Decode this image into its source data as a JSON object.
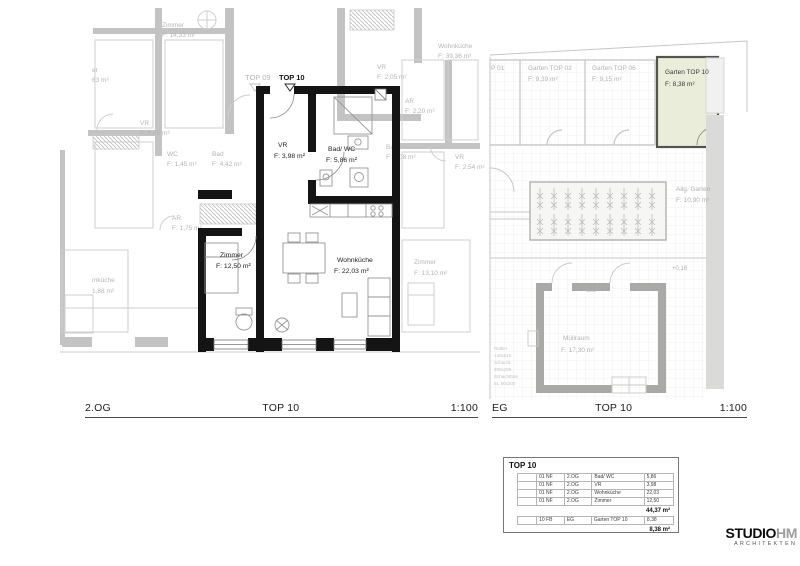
{
  "plan_og": {
    "footer": {
      "level": "2.OG",
      "unit": "TOP 10",
      "scale": "1:100"
    },
    "markers": {
      "faded": "TOP 09",
      "active": "TOP 10"
    },
    "rooms": {
      "vr": {
        "name": "VR",
        "area": "F: 3,98 m²"
      },
      "bad": {
        "name": "Bad/ WC",
        "area": "F: 5,86 m²"
      },
      "zimmer": {
        "name": "Zimmer",
        "area": "F: 12,50 m²"
      },
      "wohnkueche": {
        "name": "Wohnküche",
        "area": "F: 22,03 m²"
      }
    },
    "context": [
      {
        "name": "Zimmer",
        "area": "F: 14,33 m²"
      },
      {
        "name": "er",
        "area": "63 m²"
      },
      {
        "name": "VR",
        "area": "F: 6,88 m²"
      },
      {
        "name": "WC",
        "area": "F: 1,45 m²"
      },
      {
        "name": "Bad",
        "area": "F: 4,42 m²"
      },
      {
        "name": "AR",
        "area": "F: 1,75 m²"
      },
      {
        "name": "mküche",
        "area": "1,88 m²"
      },
      {
        "name": "VR",
        "area": "F: 2,05 m²"
      },
      {
        "name": "Wohnküche",
        "area": "F: 39,36 m²"
      },
      {
        "name": "AR",
        "area": "F: 2,20 m²"
      },
      {
        "name": "Bad",
        "area": "F: 6,08 m²"
      },
      {
        "name": "VR",
        "area": "F: 2,54 m²"
      },
      {
        "name": "Zimmer",
        "area": "F: 13,10 m²"
      }
    ]
  },
  "plan_eg": {
    "footer": {
      "level": "EG",
      "unit": "TOP 10",
      "scale": "1:100"
    },
    "gardens": {
      "g01_fragment": "P 01",
      "g02": {
        "name": "Garten TOP 02",
        "area": "F: 9,39 m²"
      },
      "g06": {
        "name": "Garten TOP 06",
        "area": "F: 9,15 m²"
      },
      "g10": {
        "name": "Garten TOP 10",
        "area": "F: 8,38 m²"
      }
    },
    "allg_garten": {
      "name": "Allg. Garten",
      "area": "F: 10,90 m²"
    },
    "muellraum": {
      "name": "Müllraum",
      "area": "F: 17,30 m²"
    },
    "level_mark": "+0,16",
    "wall_label": "ELMI",
    "shaft_note": [
      "Rüttler",
      "140x510",
      "Schacht",
      "200x155",
      "Schachttüre",
      "EL 90x200"
    ]
  },
  "area_table": {
    "title": "TOP 10",
    "rows": [
      [
        "01 NF",
        "2.OG",
        "Bad/ WC",
        "5,86"
      ],
      [
        "01 NF",
        "2.OG",
        "VR",
        "3,98"
      ],
      [
        "01 NF",
        "2.OG",
        "Wohnküche",
        "22,03"
      ],
      [
        "01 NF",
        "2.OG",
        "Zimmer",
        "12,50"
      ]
    ],
    "subtotal": "44,37 m²",
    "garden_row": [
      "10 FB",
      "EG",
      "Garten TOP 10",
      "8,38"
    ],
    "total": "8,38 m²"
  },
  "logo": {
    "studio": "STUDIO",
    "hm": "HM",
    "subtitle": "ARCHITEKTEN"
  },
  "colors": {
    "active_walls": "#141414",
    "faded_drawing": "#b9b9b9",
    "garden_highlight_fill": "#e9edda",
    "garden_highlight_border": "#54544c"
  }
}
